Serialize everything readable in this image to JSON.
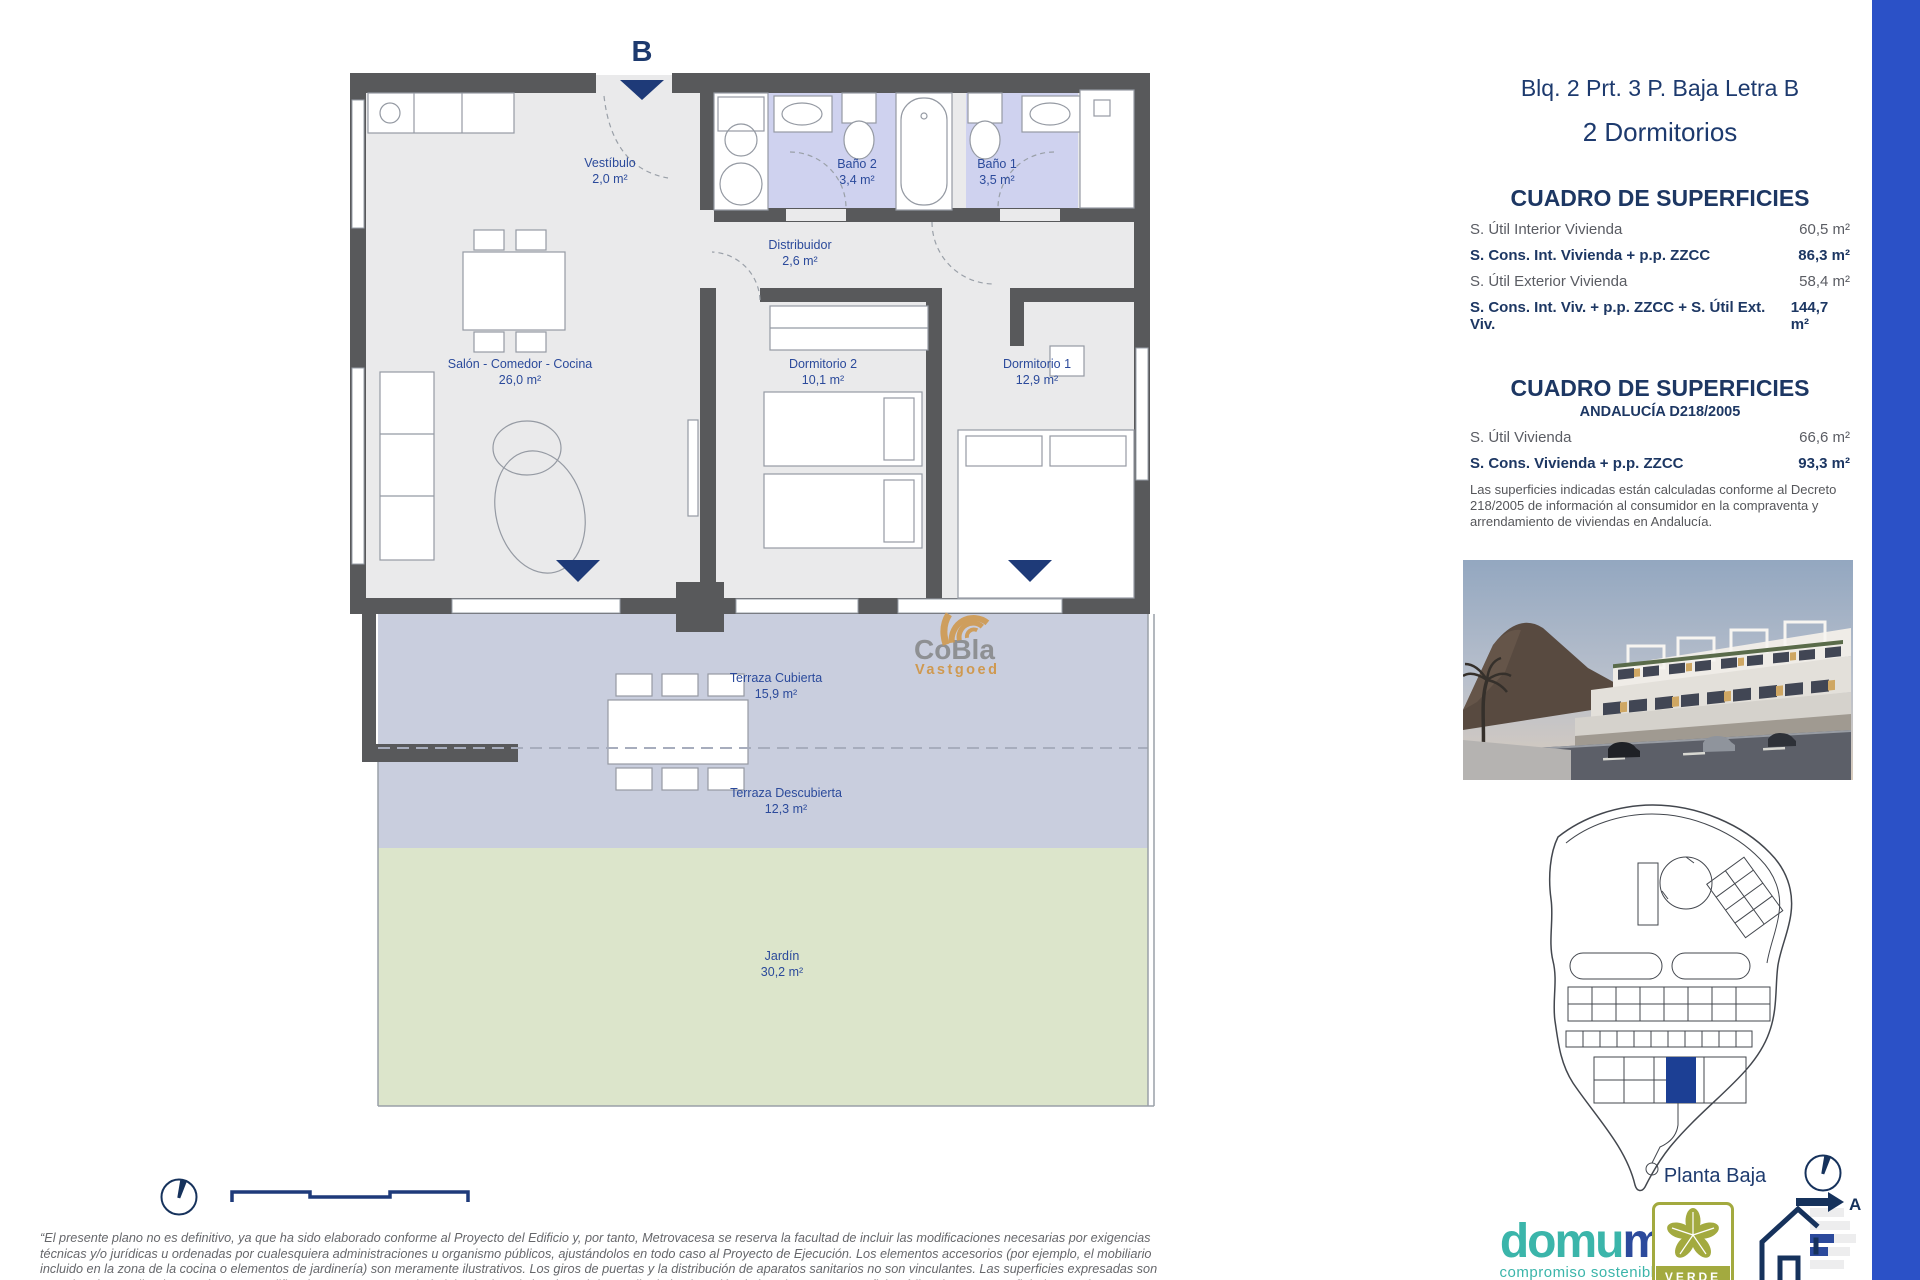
{
  "colors": {
    "accent_bar": "#2b51c7",
    "navy": "#1d3a6e",
    "plan_label_blue": "#2b4a9b",
    "wall_gray": "#58595b",
    "bath_lavender": "#cfd2ef",
    "terrace_blue": "#c9cede",
    "garden_green": "#dce5cb",
    "domum_teal": "#3bb5aa",
    "domum_navy": "#2c4a9c",
    "verde_olive": "#a3aa3f",
    "cobla_gray": "#8e9093",
    "cobla_orange": "#cf9950"
  },
  "plan": {
    "entrance_label": "B",
    "rooms": [
      {
        "name": "Vestíbulo",
        "area": "2,0 m²"
      },
      {
        "name": "Baño 2",
        "area": "3,4 m²"
      },
      {
        "name": "Baño 1",
        "area": "3,5 m²"
      },
      {
        "name": "Distribuidor",
        "area": "2,6 m²"
      },
      {
        "name": "Salón - Comedor - Cocina",
        "area": "26,0 m²"
      },
      {
        "name": "Dormitorio 2",
        "area": "10,1 m²"
      },
      {
        "name": "Dormitorio 1",
        "area": "12,9 m²"
      },
      {
        "name": "Terraza Cubierta",
        "area": "15,9 m²"
      },
      {
        "name": "Terraza Descubierta",
        "area": "12,3 m²"
      },
      {
        "name": "Jardín",
        "area": "30,2 m²"
      }
    ]
  },
  "watermark": {
    "line1": "CoBla",
    "line2": "Vastgoed"
  },
  "panel": {
    "title": "Blq. 2 Prt. 3 P. Baja Letra B",
    "subtitle": "2 Dormitorios",
    "surfaces": {
      "heading": "CUADRO DE SUPERFICIES",
      "rows": [
        {
          "label": "S. Útil Interior Vivienda",
          "value": "60,5 m²"
        },
        {
          "label": "S. Cons. Int. Vivienda + p.p. ZZCC",
          "value": "86,3 m²"
        },
        {
          "label": "S. Útil Exterior Vivienda",
          "value": "58,4 m²"
        },
        {
          "label": "S. Cons. Int. Viv. + p.p. ZZCC + S. Útil Ext. Viv.",
          "value": "144,7 m²"
        }
      ]
    },
    "surfaces_andalucia": {
      "heading": "CUADRO DE SUPERFICIES",
      "subheading": "ANDALUCÍA D218/2005",
      "rows": [
        {
          "label": "S. Útil Vivienda",
          "value": "66,6 m²"
        },
        {
          "label": "S. Cons. Vivienda + p.p. ZZCC",
          "value": "93,3 m²"
        }
      ],
      "note": "Las superficies indicadas están calculadas conforme al Decreto 218/2005 de información al consumidor en la compraventa y arrendamiento de viviendas en Andalucía."
    },
    "floor_label": "Planta Baja"
  },
  "footer": {
    "disclaimer": "“El presente plano no es definitivo, ya que ha sido elaborado conforme al Proyecto del Edificio y, por tanto, Metrovacesa se reserva la facultad de incluir las modificaciones necesarias por exigencias técnicas y/o jurídicas u ordenadas por cualesquiera administraciones u organismo públicos, ajustándolos en todo caso al Proyecto de Ejecución. Los elementos accesorios (por ejemplo, el mobiliario incluido en la zona de la cocina o elementos de jardinería) son meramente ilustrativos. Los giros de puertas y la distribución de aparatos sanitarios no son vinculantes. Las superficies expresadas son aproximadas, pudiendo experimentar modificaciones por razones de índole técnico y/o legal en el desarrollo de la ejecución de las obras. Las superficies útiles de terrazas reflejadas en plano son reales, computan en la superficie útil total de VP (Calificación Provisional) según normativa vigente. La clasificación final de los sellos de sostenibilidad se obtendrán tras el desarrollo del Proyecto de Ejecución.”",
    "domum_part1": "domu",
    "domum_part2": "m",
    "domum_tagline": "compromiso sostenible",
    "verde": "VERDE",
    "energy_rating": "A"
  }
}
